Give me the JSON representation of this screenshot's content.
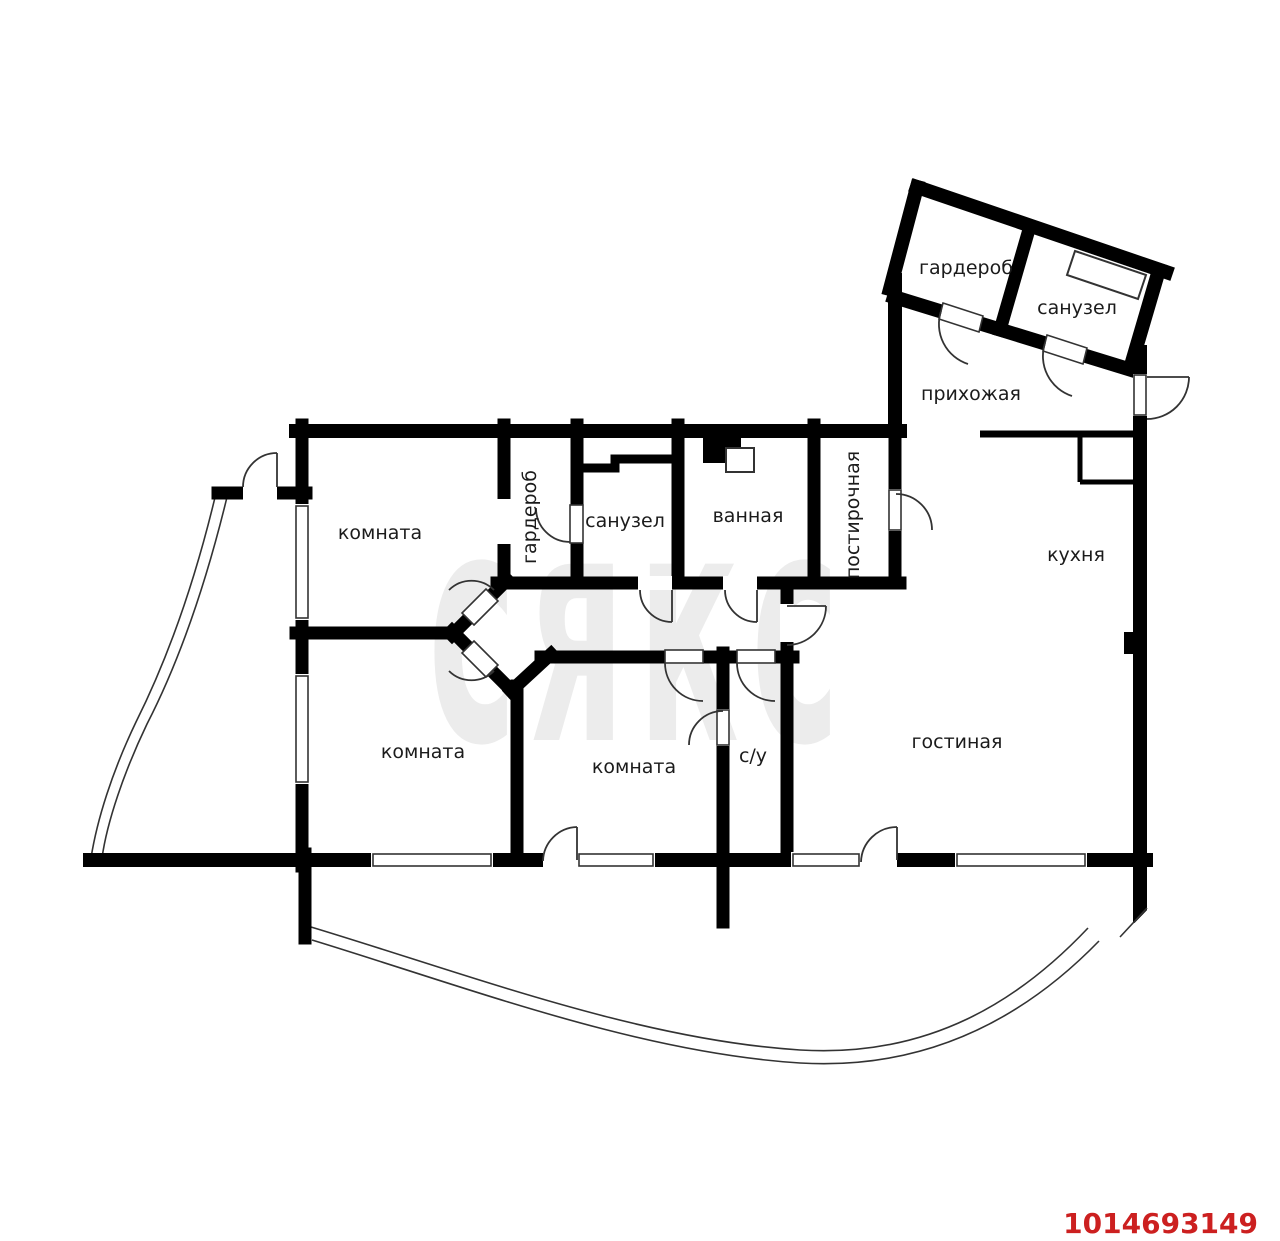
{
  "plan": {
    "watermark": "сякс",
    "listing_id": "1014693149",
    "rooms": {
      "wardrobe_annex": "гардероб",
      "sanuzel_annex": "санузел",
      "hallway": "прихожая",
      "room_top": "комната",
      "wardrobe_inner": "гардероб",
      "sanuzel_top": "санузел",
      "bath": "ванная",
      "laundry": "постирочная",
      "kitchen": "кухня",
      "room_bottom_left": "комната",
      "room_bottom_mid": "комната",
      "wc": "с/у",
      "living_room": "гостиная"
    },
    "colors": {
      "wall": "#000000",
      "door": "#333333",
      "watermark": "#ececec",
      "listing_id": "#cc2020"
    }
  }
}
